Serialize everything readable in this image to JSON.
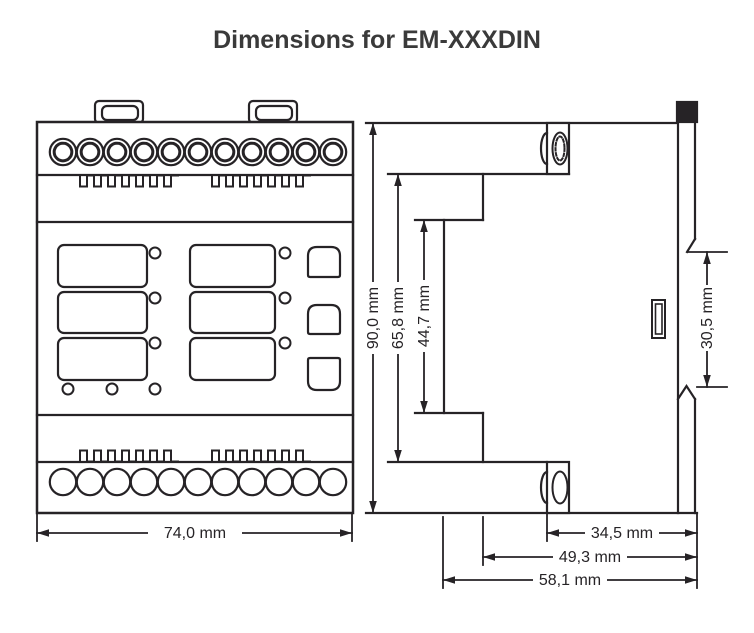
{
  "header": {
    "title": "Dimensions for EM-XXXDIN"
  },
  "colors": {
    "line": "#262326",
    "background": "#ffffff",
    "title_text": "#3a3a3a"
  },
  "front_view": {
    "top_terminal_count": 11,
    "bottom_terminal_count": 11,
    "display_window_count": 6,
    "led_count": 6,
    "button_count": 3,
    "panel_dot_count": 3,
    "mounting_tab_count": 2
  },
  "dimensions": {
    "front_width": "74,0 mm",
    "overall_height": "90,0 mm",
    "inner_height": "65,8 mm",
    "face_height": "44,7 mm",
    "clip_height": "30,5 mm",
    "top_depth": "34,5 mm",
    "mid_depth": "49,3 mm",
    "overall_depth": "58,1 mm"
  }
}
